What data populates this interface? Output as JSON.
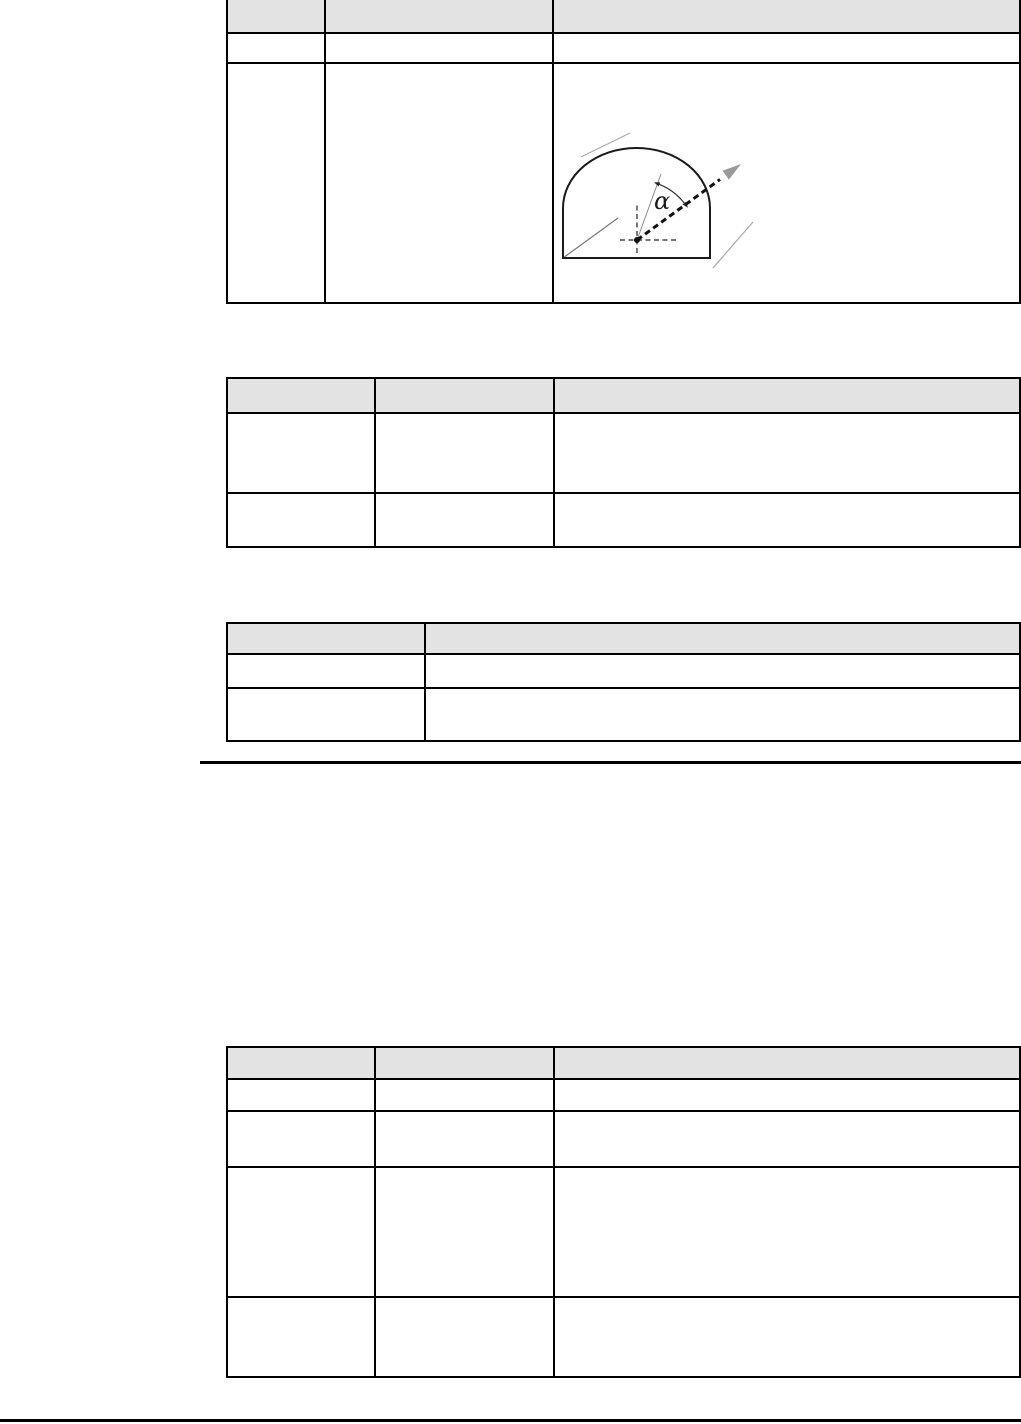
{
  "document": {
    "description": "Manual page fragment with four tables (cells empty) and a tunnel-profile angle diagram",
    "diagram": {
      "angle_label": "α"
    },
    "tables": [
      {
        "id": "table-1",
        "columns": 3,
        "header": [
          "",
          "",
          ""
        ],
        "rows": [
          [
            "",
            "",
            ""
          ],
          [
            "",
            "",
            ""
          ]
        ]
      },
      {
        "id": "table-2",
        "columns": 3,
        "header": [
          "",
          "",
          ""
        ],
        "rows": [
          [
            "",
            "",
            ""
          ],
          [
            "",
            "",
            ""
          ]
        ]
      },
      {
        "id": "table-3",
        "columns": 2,
        "header": [
          "",
          ""
        ],
        "rows": [
          [
            "",
            ""
          ],
          [
            "",
            ""
          ]
        ]
      },
      {
        "id": "table-4",
        "columns": 3,
        "header": [
          "",
          "",
          ""
        ],
        "rows": [
          [
            "",
            "",
            ""
          ],
          [
            "",
            "",
            ""
          ],
          [
            "",
            "",
            ""
          ],
          [
            "",
            "",
            ""
          ]
        ]
      }
    ],
    "colors": {
      "page_bg": "#ffffff",
      "table_header_bg": "#e3e3e3",
      "table_border": "#000000",
      "rule_color": "#000000",
      "diagram_gray": "#9a9a9a"
    }
  }
}
